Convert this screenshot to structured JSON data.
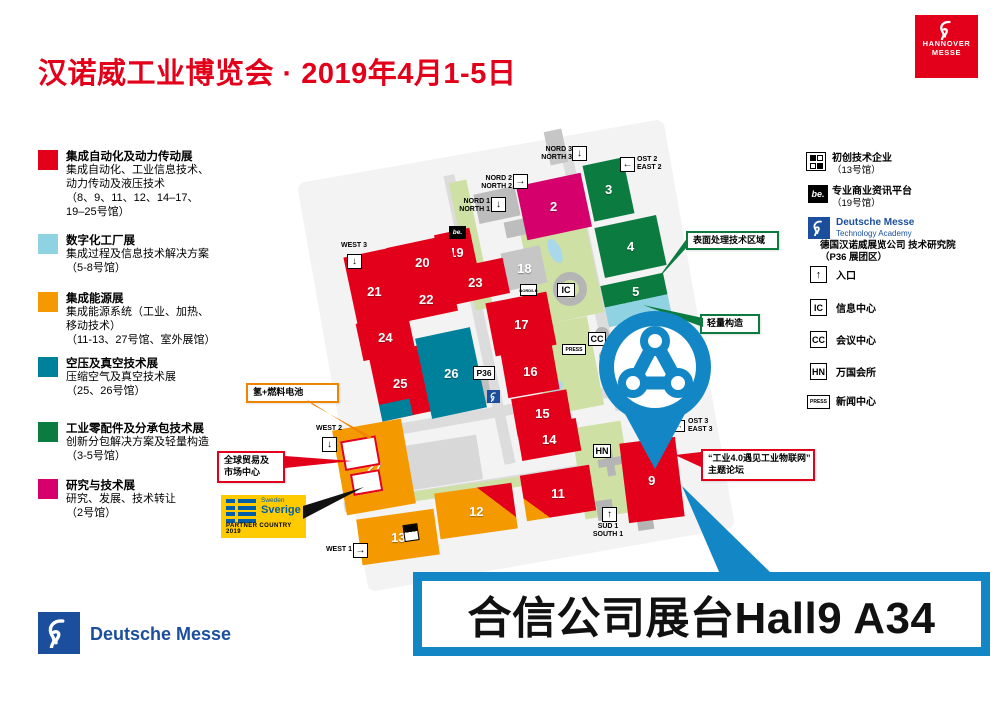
{
  "header": {
    "title": "汉诺威工业博览会 · 2019年4月1-5日"
  },
  "logo": {
    "line1": "HANNOVER",
    "line2": "MESSE"
  },
  "legend_left": [
    {
      "color": "#e2001a",
      "title": "集成自动化及动力传动展",
      "lines": [
        "集成自动化、工业信息技术、",
        "动力传动及液压技术",
        "（8、9、11、12、14–17、",
        "19–25号馆）"
      ]
    },
    {
      "color": "#8fd2e2",
      "title": "数字化工厂展",
      "lines": [
        "集成过程及信息技术解决方案",
        "（5-8号馆）"
      ]
    },
    {
      "color": "#f49a00",
      "title": "集成能源展",
      "lines": [
        "集成能源系统（工业、加热、",
        "移动技术）",
        "（11-13、27号馆、室外展馆）"
      ]
    },
    {
      "color": "#00819b",
      "title": "空压及真空技术展",
      "lines": [
        "压缩空气及真空技术展",
        "（25、26号馆）"
      ]
    },
    {
      "color": "#0c7b40",
      "title": "工业零配件及分承包技术展",
      "lines": [
        "创新分包解决方案及轻量构造",
        "（3-5号馆）"
      ]
    },
    {
      "color": "#d5006c",
      "title": "研究与技术展",
      "lines": [
        "研究、发展、技术转让",
        "（2号馆）"
      ]
    }
  ],
  "legend_right": {
    "startup": {
      "line1": "初创技术企业",
      "line2": "（13号馆）"
    },
    "be": {
      "icon": "be.",
      "line1": "专业商业资讯平台",
      "line2": "（19号馆）"
    },
    "academy": {
      "brand": "Deutsche Messe",
      "brand2": "Technology Academy",
      "line1": "德国汉诺威展览公司 技术研究院",
      "line2": "（P36 展团区）"
    },
    "facilities": [
      {
        "code": "↑",
        "label": "入口"
      },
      {
        "code": "IC",
        "label": "信息中心"
      },
      {
        "code": "CC",
        "label": "会议中心"
      },
      {
        "code": "HN",
        "label": "万国会所"
      },
      {
        "code": "PRESS",
        "label": "新闻中心"
      }
    ]
  },
  "map": {
    "halls": [
      {
        "n": "2",
        "c": "#d5006c"
      },
      {
        "n": "3",
        "c": "#0c7b40"
      },
      {
        "n": "4",
        "c": "#0c7b40"
      },
      {
        "n": "5",
        "c": "#0c7b40",
        "c2": "#8fd2e2",
        "split": "v"
      },
      {
        "n": "9",
        "c": "#e2001a"
      },
      {
        "n": "11",
        "c": "#e2001a",
        "c2": "#f49a00",
        "split": "bl"
      },
      {
        "n": "12",
        "c": "#f49a00",
        "c2": "#e2001a",
        "split": "tr"
      },
      {
        "n": "13",
        "c": "#f49a00"
      },
      {
        "n": "14",
        "c": "#e2001a"
      },
      {
        "n": "15",
        "c": "#e2001a"
      },
      {
        "n": "16",
        "c": "#e2001a"
      },
      {
        "n": "17",
        "c": "#e2001a"
      },
      {
        "n": "18",
        "c": "#c6c6c6"
      },
      {
        "n": "19",
        "c": "#e2001a"
      },
      {
        "n": "20",
        "c": "#e2001a"
      },
      {
        "n": "21",
        "c": "#e2001a"
      },
      {
        "n": "22",
        "c": "#e2001a"
      },
      {
        "n": "23",
        "c": "#e2001a"
      },
      {
        "n": "24",
        "c": "#e2001a"
      },
      {
        "n": "25",
        "c": "#e2001a"
      },
      {
        "n": "26",
        "c": "#00819b"
      },
      {
        "n": "27",
        "c": "#f49a00"
      }
    ],
    "entrances": {
      "nord3": {
        "l1": "NORD 3",
        "l2": "NORTH 3",
        "arrow": "↓"
      },
      "ost2": {
        "l1": "OST 2",
        "l2": "EAST 2",
        "arrow": "←"
      },
      "nord2": {
        "l1": "NORD 2",
        "l2": "NORTH 2",
        "arrow": "→"
      },
      "nord1": {
        "l1": "NORD 1",
        "l2": "NORTH 1",
        "arrow": "↓"
      },
      "west3": {
        "l1": "WEST 3",
        "arrow": "↓"
      },
      "west2": {
        "l1": "WEST 2",
        "arrow": "↓"
      },
      "west1": {
        "l1": "WEST 1",
        "arrow": "→"
      },
      "sued1": {
        "l1": "SÜD 1",
        "l2": "SOUTH 1",
        "arrow": "↑"
      }
    },
    "markers": {
      "ic": "IC",
      "cc": "CC",
      "press": "PRESS",
      "hn": "HN",
      "p36": "P36",
      "be": "be.",
      "nordlb": "NORD/LB",
      "ost3_l1": "OST 3",
      "ost3_l2": "EAST 3"
    },
    "callouts": {
      "surface": "表面处理技术区域",
      "lightweight": "轻量构造",
      "iot_l1": "“工业4.0遇见工业物联网”",
      "iot_l2": "主题论坛",
      "hydrogen": "氢+燃料电池",
      "trade_l1": "全球贸易及",
      "trade_l2": "市场中心"
    },
    "partner": {
      "country": "Sweden",
      "name": "Sverige",
      "caption": "PARTNER COUNTRY 2019"
    }
  },
  "banner": {
    "text": "合信公司展台Hall9 A34"
  },
  "footer": {
    "brand": "Deutsche Messe"
  }
}
